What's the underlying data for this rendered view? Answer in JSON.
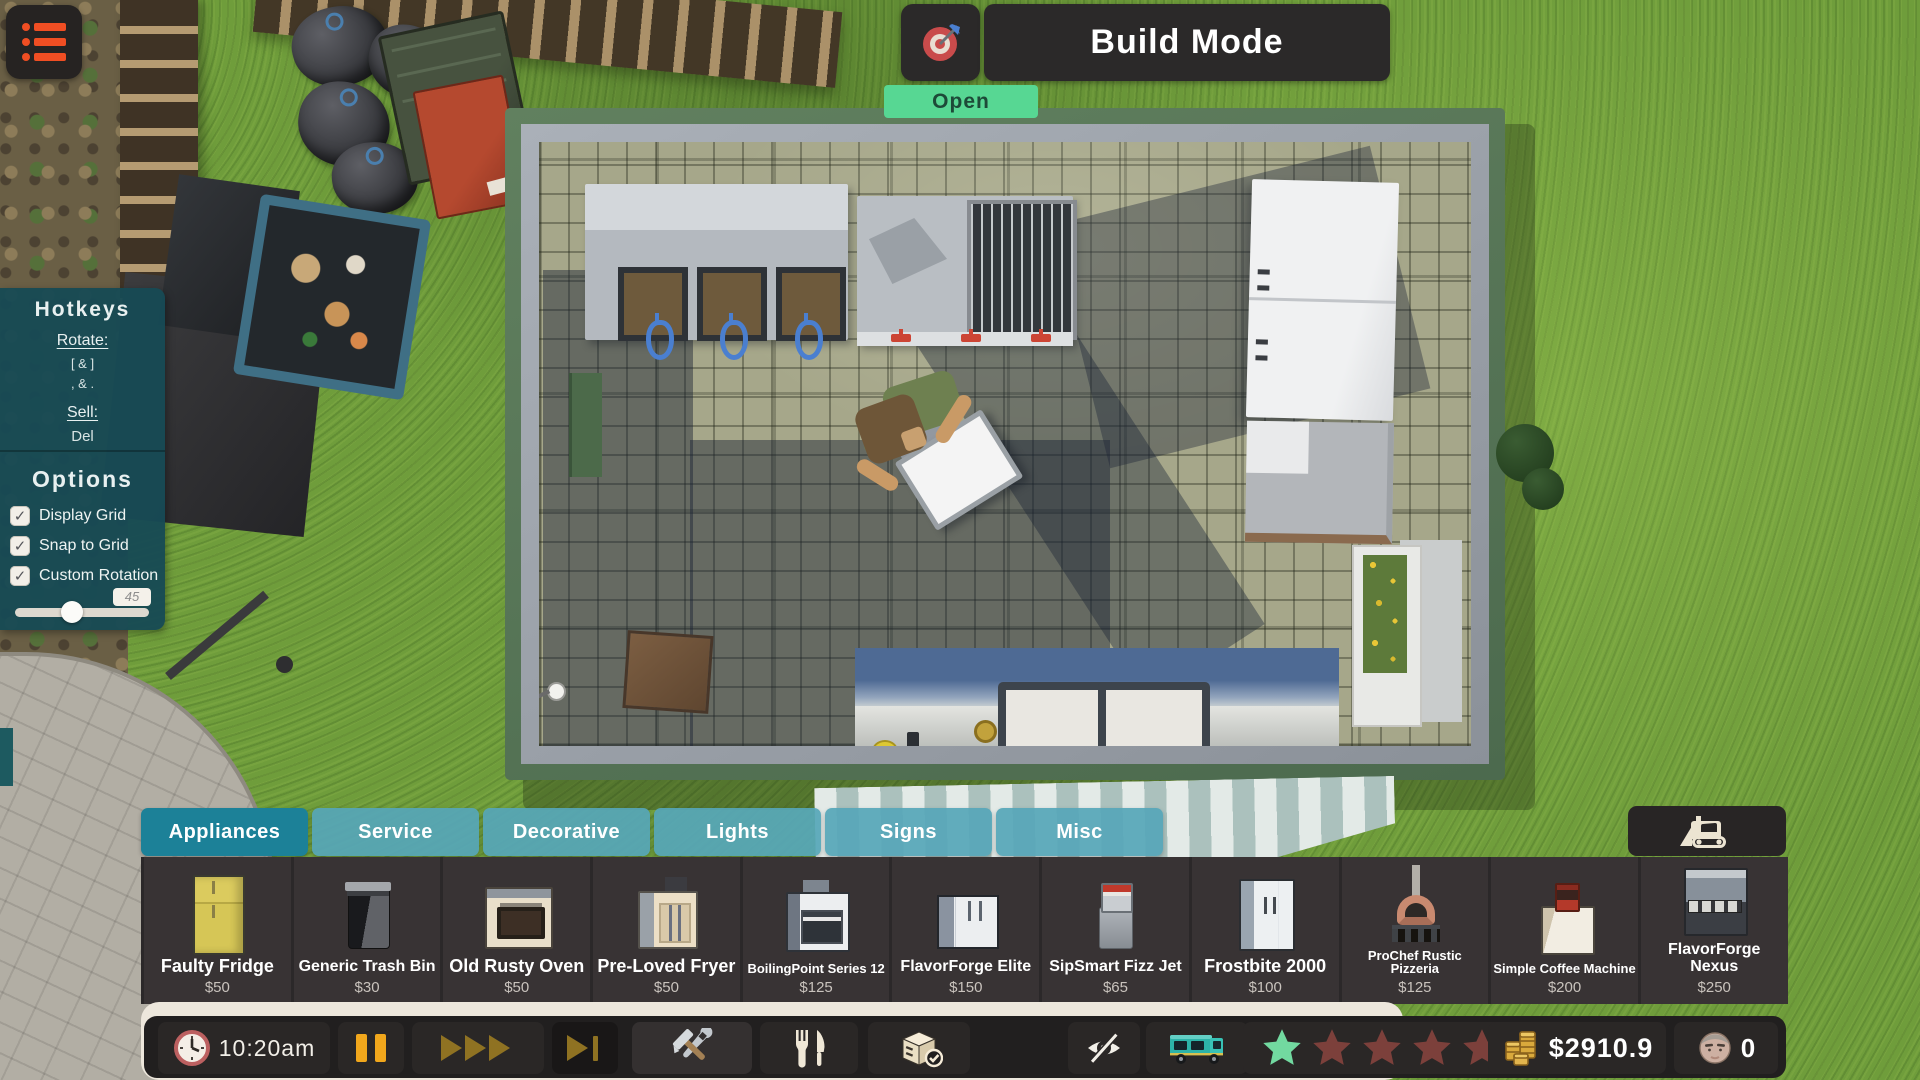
{
  "header": {
    "title": "Build Mode",
    "open_label": "Open"
  },
  "hotkeys": {
    "title": "Hotkeys",
    "rotate_label": "Rotate:",
    "rotate_key_row1": "[ & ]",
    "rotate_key_row2": ", & .",
    "sell_label": "Sell:",
    "sell_key": "Del"
  },
  "options": {
    "title": "Options",
    "checkboxes": [
      {
        "label": "Display Grid",
        "checked": true
      },
      {
        "label": "Snap to Grid",
        "checked": true
      },
      {
        "label": "Custom Rotation",
        "checked": true
      }
    ],
    "rotation_value": "45"
  },
  "tabs": [
    {
      "label": "Appliances",
      "active": true
    },
    {
      "label": "Service",
      "active": false
    },
    {
      "label": "Decorative",
      "active": false
    },
    {
      "label": "Lights",
      "active": false
    },
    {
      "label": "Signs",
      "active": false
    },
    {
      "label": "Misc",
      "active": false
    }
  ],
  "shop_items": [
    {
      "name": "Faulty Fridge",
      "price": "$50",
      "icon": "fridge-yellow-icon"
    },
    {
      "name": "Generic Trash Bin",
      "price": "$30",
      "icon": "trash-bin-icon"
    },
    {
      "name": "Old Rusty Oven",
      "price": "$50",
      "icon": "oven-rusty-icon"
    },
    {
      "name": "Pre-Loved Fryer",
      "price": "$50",
      "icon": "fryer-icon"
    },
    {
      "name": "BoilingPoint Series 12",
      "price": "$125",
      "icon": "oven-modern-icon"
    },
    {
      "name": "FlavorForge Elite",
      "price": "$150",
      "icon": "fridge-elite-icon"
    },
    {
      "name": "SipSmart Fizz Jet",
      "price": "$65",
      "icon": "soda-dispenser-icon"
    },
    {
      "name": "Frostbite 2000",
      "price": "$100",
      "icon": "fridge-frostbite-icon"
    },
    {
      "name": "ProChef Rustic Pizzeria",
      "price": "$125",
      "icon": "pizza-oven-icon"
    },
    {
      "name": "Simple Coffee Machine",
      "price": "$200",
      "icon": "coffee-machine-icon"
    },
    {
      "name": "FlavorForge Nexus",
      "price": "$250",
      "icon": "range-nexus-icon"
    }
  ],
  "statusbar": {
    "time": "10:20am",
    "money": "$2910.9",
    "customers": "0",
    "rating_filled": 1,
    "rating_total": 5
  },
  "colors": {
    "accent_orange": "#f04e23",
    "tab_active": "#1c8198",
    "tab_inactive": "#56a6b9",
    "open_green": "#57d793",
    "star_green": "#72d9a0",
    "star_red": "#7c403b",
    "panel_teal": "#174a54",
    "pause_orange": "#f1a71c"
  }
}
